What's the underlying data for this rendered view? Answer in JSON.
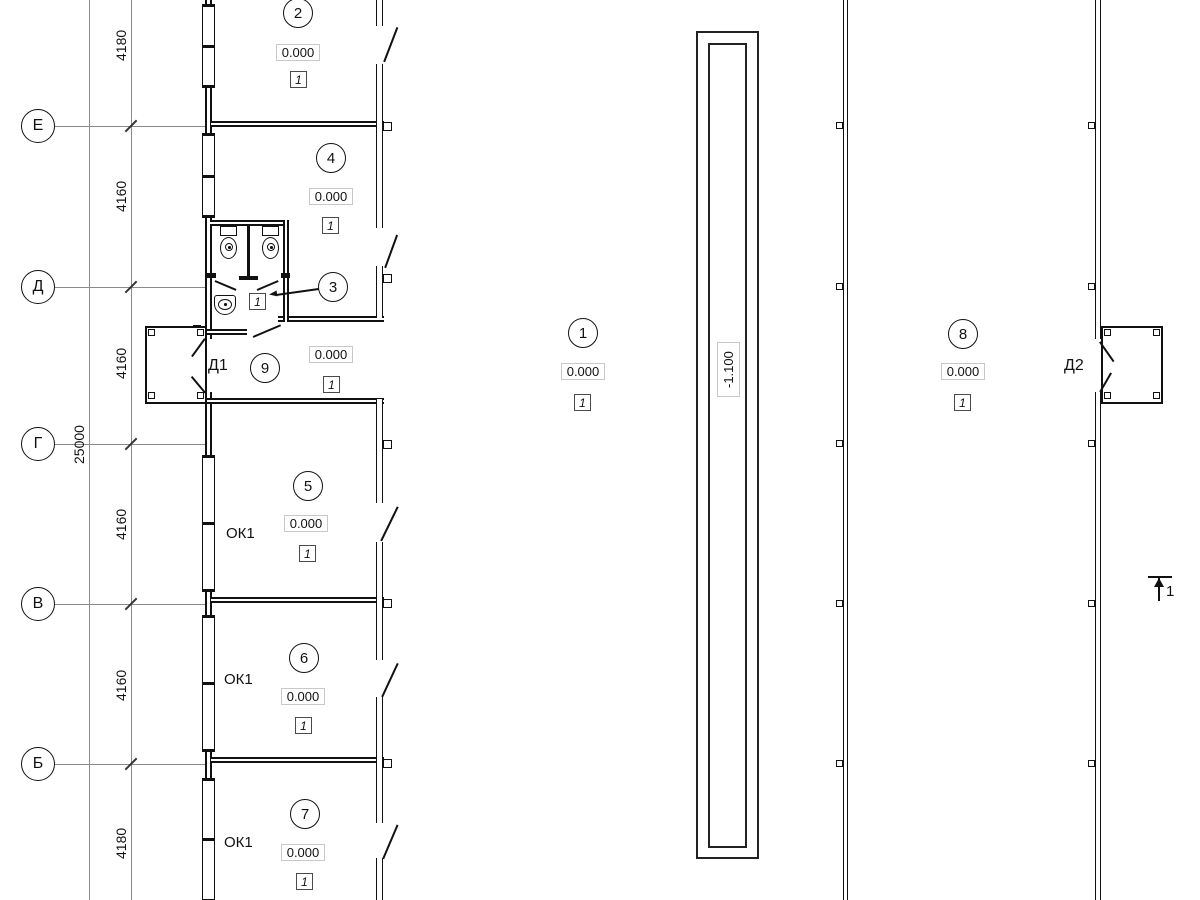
{
  "axes": [
    {
      "label": "Е"
    },
    {
      "label": "Д"
    },
    {
      "label": "Г"
    },
    {
      "label": "В"
    },
    {
      "label": "Б"
    }
  ],
  "dimensions": {
    "segments": [
      "4180",
      "4160",
      "4160",
      "4160",
      "4160",
      "4180"
    ],
    "total": "25000"
  },
  "rooms": [
    {
      "number": "2",
      "elevation": "0.000",
      "floor_type": "1"
    },
    {
      "number": "4",
      "elevation": "0.000",
      "floor_type": "1"
    },
    {
      "number": "3",
      "floor_type": "1"
    },
    {
      "number": "9",
      "elevation": "0.000",
      "floor_type": "1"
    },
    {
      "number": "5",
      "elevation": "0.000",
      "floor_type": "1"
    },
    {
      "number": "6",
      "elevation": "0.000",
      "floor_type": "1"
    },
    {
      "number": "7",
      "elevation": "0.000",
      "floor_type": "1"
    },
    {
      "number": "1",
      "elevation": "0.000",
      "floor_type": "1"
    },
    {
      "number": "8",
      "elevation": "0.000",
      "floor_type": "1"
    }
  ],
  "labels": {
    "door1": "Д1",
    "door2": "Д2",
    "window": "ОК1"
  },
  "pit": {
    "elevation": "-1.100"
  },
  "section_mark": {
    "number": "1"
  },
  "colors": {
    "wall": "#111111",
    "axis_line": "#8a8a8a",
    "elevation_box_border": "#c8c8c8"
  }
}
